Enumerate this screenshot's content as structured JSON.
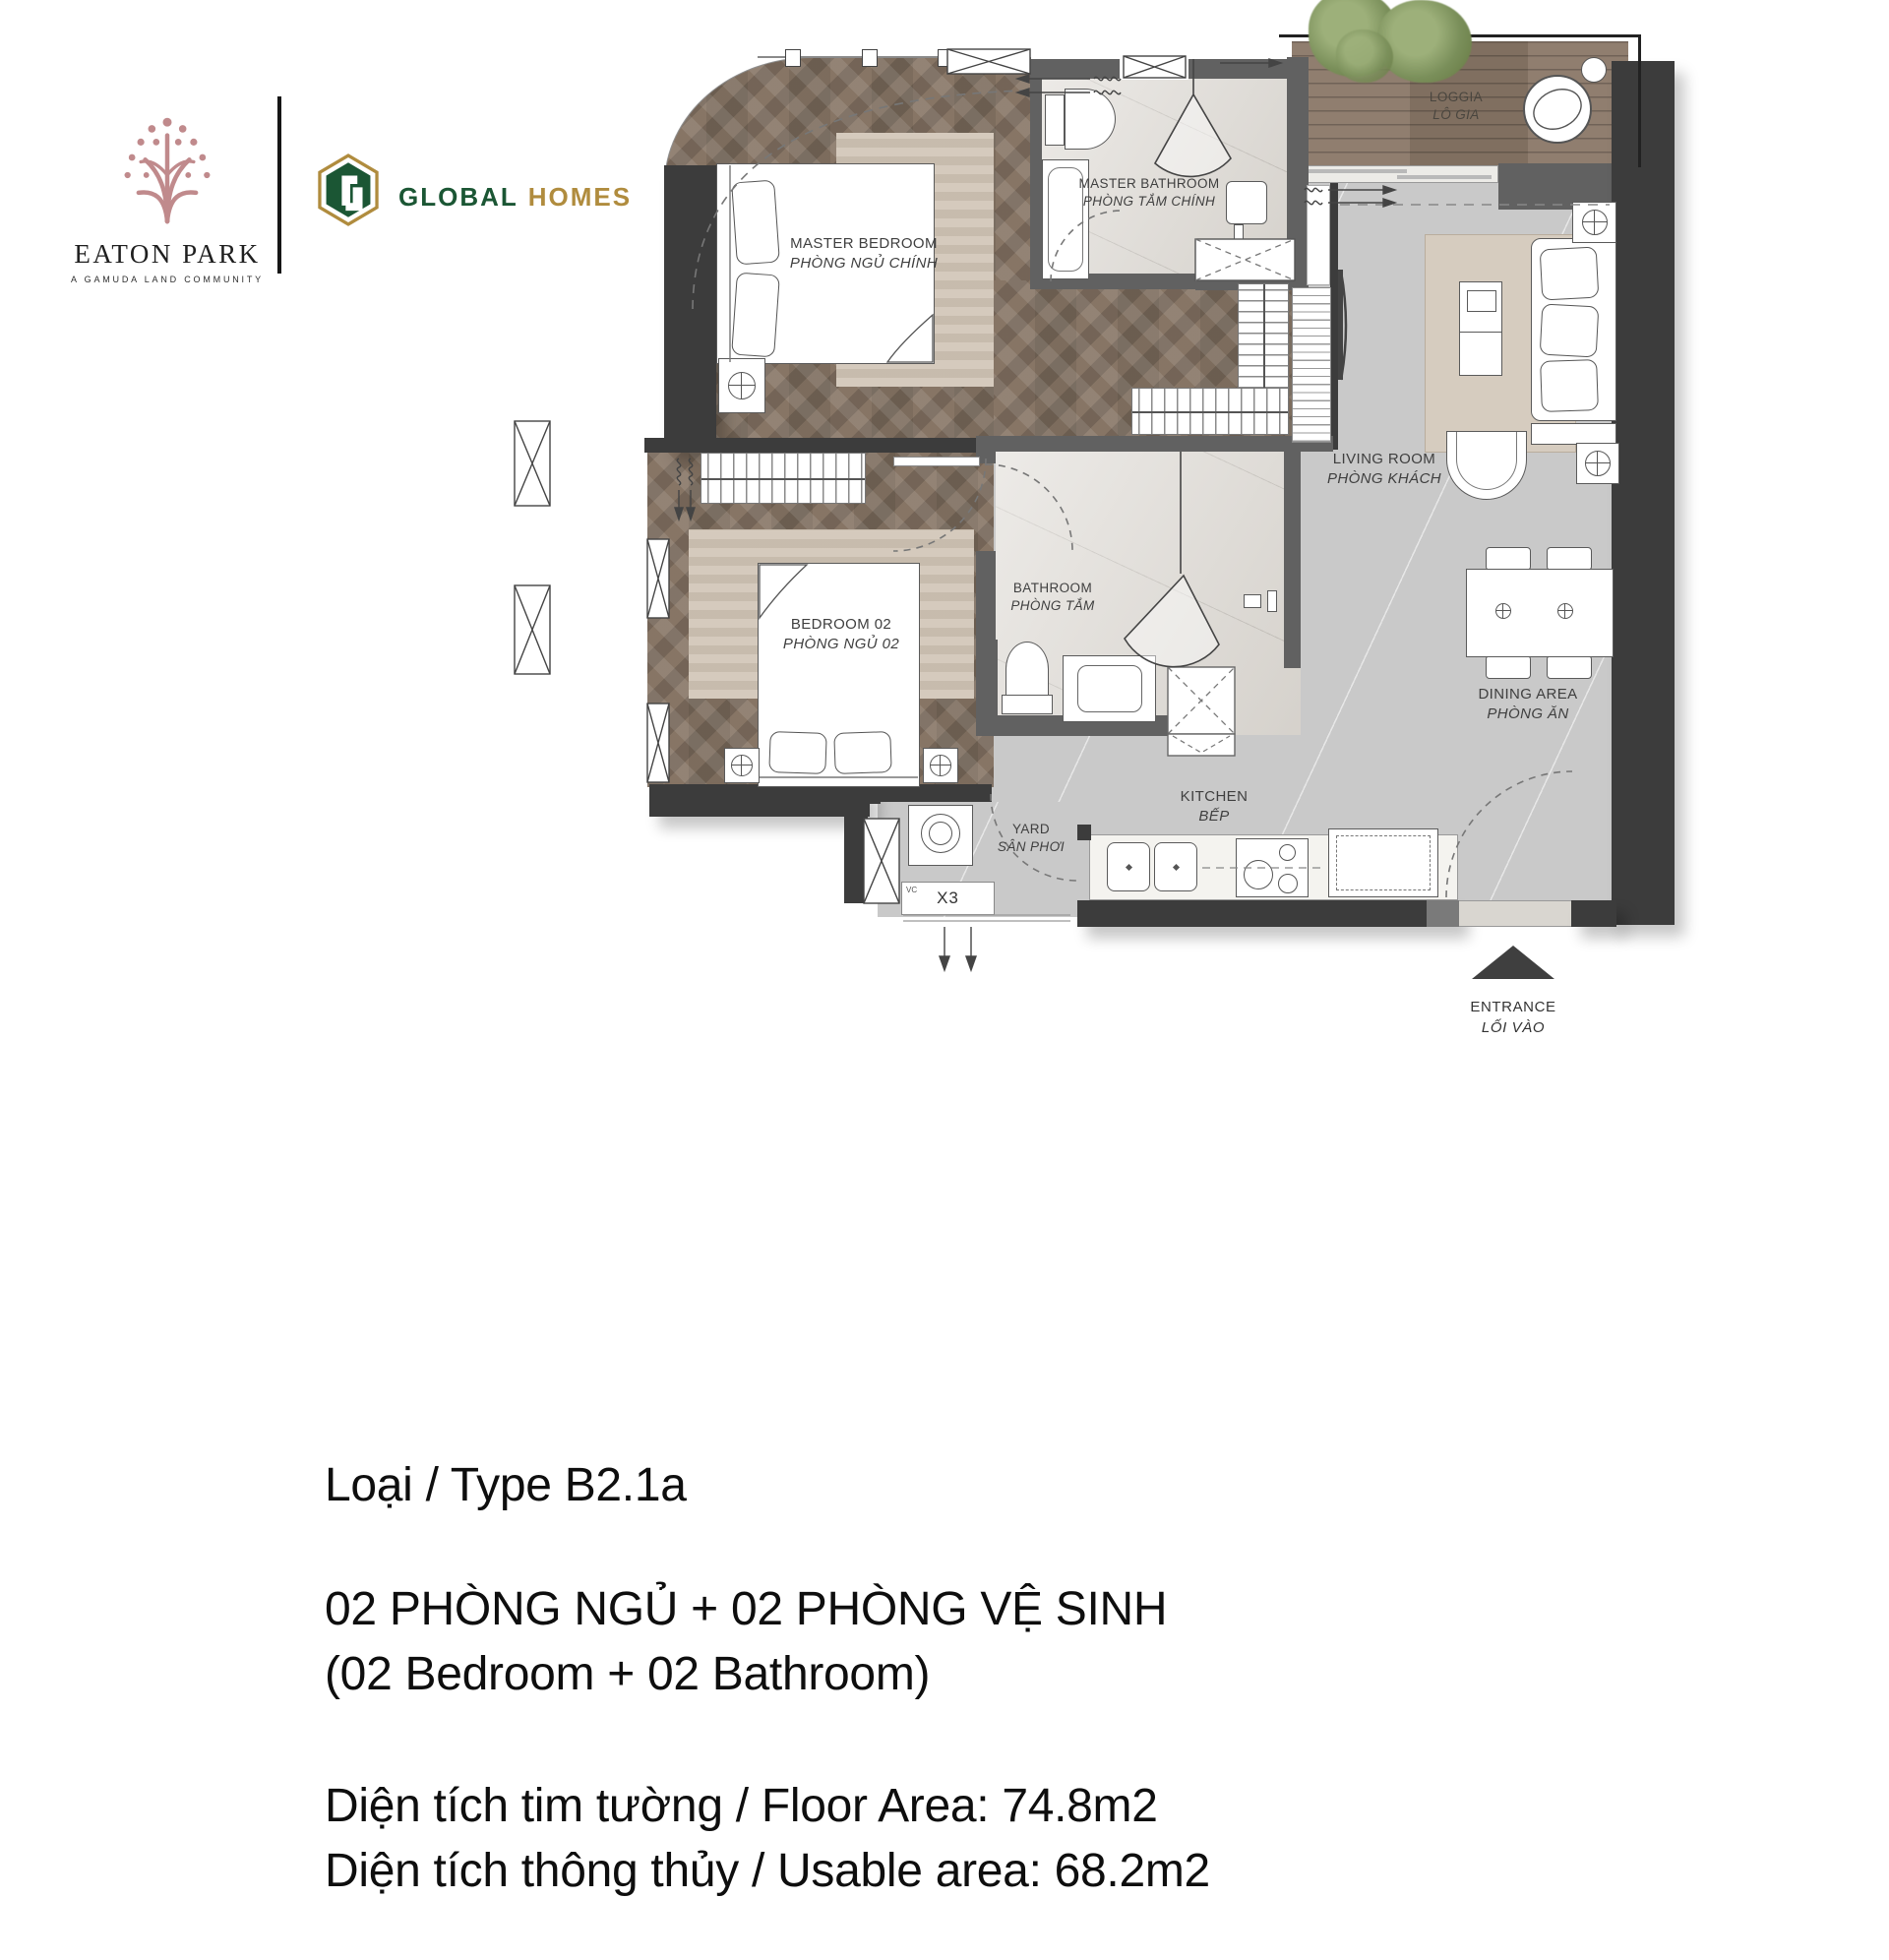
{
  "header": {
    "eaton": {
      "title": "EATON PARK",
      "tagline": "A GAMUDA LAND COMMUNITY"
    },
    "global": {
      "word1": "GLOBAL",
      "word2": "HOMES"
    }
  },
  "plan": {
    "labels": {
      "master_bedroom": {
        "en": "MASTER BEDROOM",
        "vi": "PHÒNG NGỦ CHÍNH"
      },
      "master_bathroom": {
        "en": "MASTER BATHROOM",
        "vi": "PHÒNG TẮM CHÍNH"
      },
      "loggia": {
        "en": "LOGGIA",
        "vi": "LÔ GIA"
      },
      "living_room": {
        "en": "LIVING ROOM",
        "vi": "PHÒNG KHÁCH"
      },
      "bedroom_02": {
        "en": "BEDROOM 02",
        "vi": "PHÒNG NGỦ 02"
      },
      "bathroom": {
        "en": "BATHROOM",
        "vi": "PHÒNG TẮM"
      },
      "dining_area": {
        "en": "DINING AREA",
        "vi": "PHÒNG ĂN"
      },
      "kitchen": {
        "en": "KITCHEN",
        "vi": "BẾP"
      },
      "yard": {
        "en": "YARD",
        "vi": "SÂN PHƠI"
      },
      "entrance": {
        "en": "ENTRANCE",
        "vi": "LỐI VÀO"
      },
      "service_box": {
        "code": "X3",
        "sub": "VC"
      }
    }
  },
  "details": {
    "type_line": "Loại / Type B2.1a",
    "bedrooms_vi": "02 PHÒNG NGỦ + 02 PHÒNG VỆ SINH",
    "bedrooms_en": "(02 Bedroom + 02 Bathroom)",
    "floor_area": "Diện tích tim tường / Floor Area: 74.8m2",
    "usable_area": "Diện tích thông thủy / Usable area: 68.2m2"
  },
  "colors": {
    "brand_rose": "#c08a8c",
    "brand_green": "#1b5634",
    "brand_gold": "#b08c3e",
    "wall_dark": "#3c3c3c",
    "wood": "#8d7c6c",
    "tile": "#dedad4",
    "floor_gray": "#c9c9c9",
    "rug_beige": "#cfc3b4",
    "deck": "#8a7767"
  }
}
